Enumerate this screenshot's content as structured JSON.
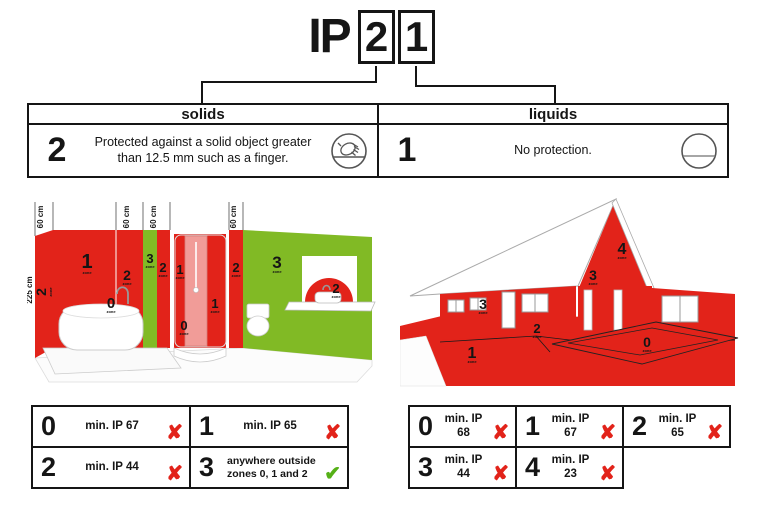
{
  "title": {
    "prefix": "IP",
    "solids_digit": "2",
    "liquids_digit": "1"
  },
  "rating_table": {
    "solids": {
      "header": "solids",
      "digit": "2",
      "description": "Protected against a solid object greater than 12.5 mm such as a finger.",
      "icon": "hand-touch-icon"
    },
    "liquids": {
      "header": "liquids",
      "digit": "1",
      "description": "No protection.",
      "icon": "no-protection-icon"
    }
  },
  "bathroom": {
    "height_label": "225 cm",
    "measure_labels": [
      "60 cm",
      "60 cm",
      "60 cm",
      "60 cm",
      "60 cm",
      "60 cm"
    ],
    "zone_word": "zone",
    "zones": {
      "side_wall": "2",
      "above_bath": "1",
      "right_col": "2",
      "green_strip": "3",
      "red_strip": "2",
      "shower_left": "1",
      "shower_inner": "1",
      "shower_floor": "0",
      "bathtub": "0",
      "right_strip": "2",
      "green_wall": "3",
      "washbasin": "2"
    }
  },
  "house": {
    "zone_word": "zone",
    "zones": {
      "ground": "1",
      "perimeter": "2",
      "front_wall": "3",
      "gable_side": "3",
      "gable": "4",
      "pool": "0"
    }
  },
  "bathroom_ip_table": {
    "cells": [
      {
        "zone": "0",
        "req": "min. IP 67",
        "mark": "x"
      },
      {
        "zone": "1",
        "req": "min. IP 65",
        "mark": "x"
      },
      {
        "zone": "2",
        "req": "min. IP 44",
        "mark": "x"
      },
      {
        "zone": "3",
        "req": "anywhere outside zones 0, 1 and 2",
        "mark": "check"
      }
    ]
  },
  "outdoor_ip_table": {
    "cells": [
      {
        "zone": "0",
        "req": "min. IP 68",
        "mark": "x"
      },
      {
        "zone": "1",
        "req": "min. IP 67",
        "mark": "x"
      },
      {
        "zone": "2",
        "req": "min. IP 65",
        "mark": "x"
      },
      {
        "zone": "3",
        "req": "min. IP 44",
        "mark": "x"
      },
      {
        "zone": "4",
        "req": "min. IP 23",
        "mark": "x"
      }
    ]
  },
  "colors": {
    "zone_red": "#e2231a",
    "zone_green": "#81ba25",
    "cross_red": "#e2231a",
    "check_green": "#55b017",
    "line_black": "#151515"
  }
}
